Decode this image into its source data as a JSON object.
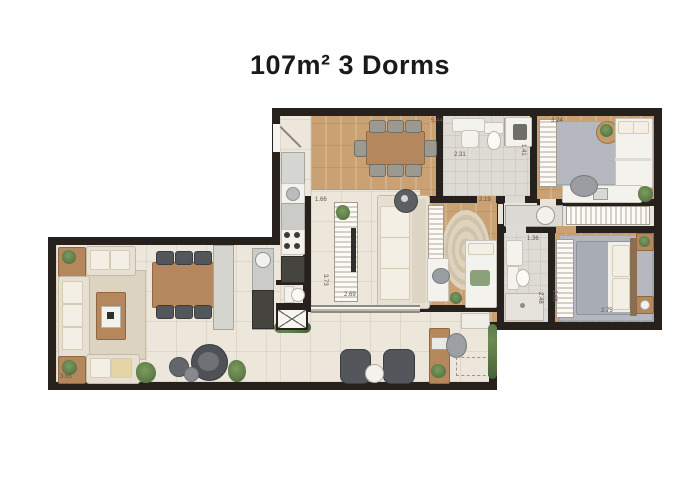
{
  "title": "107m² 3 Dorms",
  "plan": {
    "dimensions": {
      "dining_width": "5.44",
      "bath1_width": "2.31",
      "bath1_depth": "1.41",
      "bedroom1_width": "3.24",
      "kitchen_width": "1.66",
      "living_depth": "3.73",
      "living_width": "2.69",
      "bedroom2_width": "2.19",
      "bath2_width": "1.36",
      "bath2_depth": "2.48",
      "bedroom3_depth": "2.68",
      "bedroom3_width": "2.75",
      "balcony_width": "3.55"
    },
    "colors": {
      "wall": "#26211c",
      "wood_floor": "#c9a173",
      "tile_floor": "#ece6db",
      "bath_floor": "#dedbd4",
      "accent_green": "#5f7f4c",
      "title_text": "#1a1a1a",
      "dimension_text": "#5f5348"
    }
  }
}
